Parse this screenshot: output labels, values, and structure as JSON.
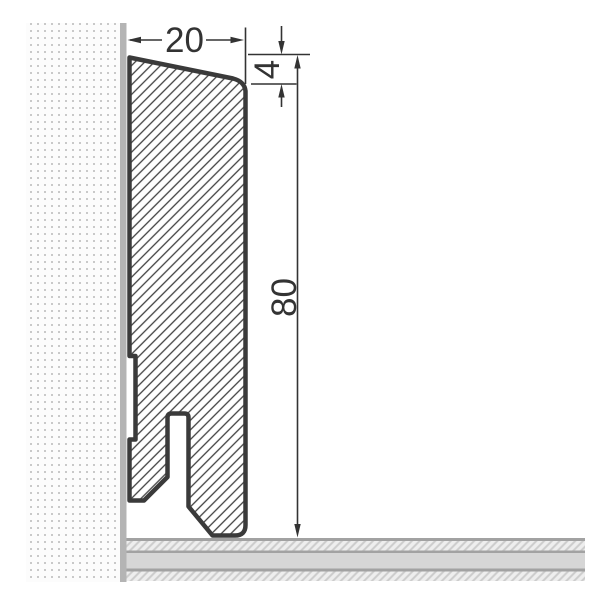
{
  "drawing": {
    "title": "skirting-board-profile-cross-section",
    "dimensions": {
      "width_label": "20",
      "top_bevel_label": "4",
      "height_label": "80"
    },
    "colors": {
      "background": "#ffffff",
      "profile_outline": "#3a3a3a",
      "profile_hatch": "#404040",
      "dimension": "#333333",
      "wall_surface": "#b4b4b4",
      "wall_dot": "#c9c9c9",
      "wall_fill": "#fcfcfc",
      "floor_line": "#a2a2a2",
      "floor_solid": "#d6d6d6",
      "floor_hatch_bg": "#eeeeee",
      "floor_hatch_line": "#cccccc"
    }
  }
}
